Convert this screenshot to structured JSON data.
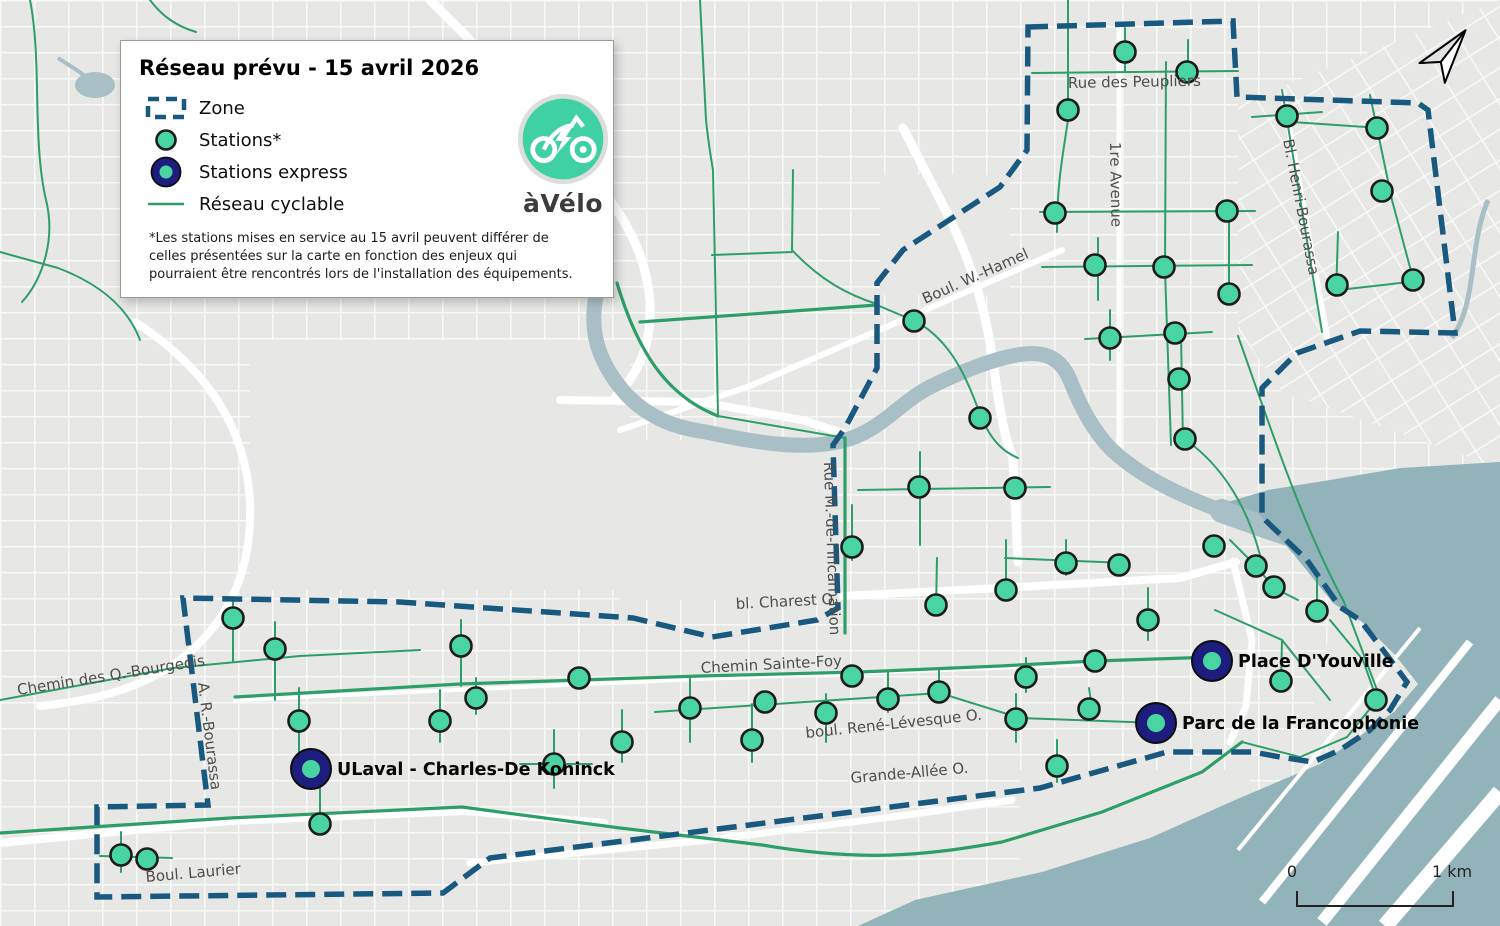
{
  "legend": {
    "title": "Réseau prévu - 15 avril 2026",
    "items": [
      {
        "id": "zone",
        "label": "Zone"
      },
      {
        "id": "station",
        "label": "Stations*"
      },
      {
        "id": "express",
        "label": "Stations express"
      },
      {
        "id": "network",
        "label": "Réseau cyclable"
      }
    ],
    "footnote": "*Les stations mises en service au 15 avril peuvent différer de celles présentées sur la carte en fonction des enjeux qui pourraient être rencontrés lors de l'installation des équipements."
  },
  "logo": {
    "brand": "àVélo"
  },
  "scale_bar": {
    "start_label": "0",
    "end_label": "1 km"
  },
  "colors": {
    "land": "#e7e8e5",
    "road": "#ffffff",
    "water_bay": "#93b3ba",
    "water_river": "#a9bfc6",
    "bike_network": "#2e9e68",
    "zone_boundary": "#19597f",
    "station_fill": "#49d5a2",
    "station_stroke": "#1c1c1c",
    "express_ring": "#1d1d7e",
    "logo_teal": "#3fd0a4",
    "street_label": "#4d4d4d",
    "station_label": "#050505"
  },
  "map": {
    "street_labels": [
      {
        "text": "Rue des Peupliers",
        "x": 1068,
        "y": 88,
        "rotate": -1
      },
      {
        "text": "1re Avenue",
        "x": 1110,
        "y": 142,
        "rotate": 89
      },
      {
        "text": "Bl. Henri-Bourassa",
        "x": 1283,
        "y": 140,
        "rotate": 79
      },
      {
        "text": "Boul. W.-Hamel",
        "x": 925,
        "y": 304,
        "rotate": -24
      },
      {
        "text": "Rue M.-de-l'Incarnation",
        "x": 824,
        "y": 462,
        "rotate": 88
      },
      {
        "text": "bl. Charest O.",
        "x": 736,
        "y": 609,
        "rotate": -3
      },
      {
        "text": "Chemin Sainte-Foy",
        "x": 701,
        "y": 673,
        "rotate": -3
      },
      {
        "text": "boul. René-Lévesque O.",
        "x": 806,
        "y": 738,
        "rotate": -6
      },
      {
        "text": "Grande-Allée O.",
        "x": 851,
        "y": 783,
        "rotate": -5
      },
      {
        "text": "Chemin des Q.-Bourgeois",
        "x": 18,
        "y": 695,
        "rotate": -9
      },
      {
        "text": "A. R.-Bourassa",
        "x": 198,
        "y": 683,
        "rotate": 83
      },
      {
        "text": "Boul. Laurier",
        "x": 146,
        "y": 882,
        "rotate": -5
      }
    ],
    "stations": [
      [
        1125,
        52
      ],
      [
        1187,
        72
      ],
      [
        1068,
        110
      ],
      [
        1287,
        116
      ],
      [
        1377,
        128
      ],
      [
        1382,
        191
      ],
      [
        1055,
        213
      ],
      [
        1227,
        211
      ],
      [
        1095,
        265
      ],
      [
        1164,
        267
      ],
      [
        1229,
        294
      ],
      [
        1337,
        285
      ],
      [
        1413,
        280
      ],
      [
        914,
        321
      ],
      [
        1110,
        338
      ],
      [
        1175,
        333
      ],
      [
        1179,
        379
      ],
      [
        980,
        418
      ],
      [
        1185,
        439
      ],
      [
        919,
        487
      ],
      [
        1015,
        488
      ],
      [
        852,
        547
      ],
      [
        1066,
        563
      ],
      [
        1119,
        565
      ],
      [
        1214,
        546
      ],
      [
        1256,
        566
      ],
      [
        1274,
        587
      ],
      [
        1006,
        590
      ],
      [
        936,
        605
      ],
      [
        1148,
        620
      ],
      [
        1317,
        611
      ],
      [
        233,
        618
      ],
      [
        275,
        649
      ],
      [
        299,
        721
      ],
      [
        320,
        824
      ],
      [
        121,
        855
      ],
      [
        147,
        859
      ],
      [
        461,
        646
      ],
      [
        476,
        698
      ],
      [
        440,
        721
      ],
      [
        579,
        678
      ],
      [
        554,
        764
      ],
      [
        622,
        742
      ],
      [
        690,
        708
      ],
      [
        765,
        702
      ],
      [
        826,
        713
      ],
      [
        852,
        676
      ],
      [
        888,
        699
      ],
      [
        752,
        740
      ],
      [
        939,
        692
      ],
      [
        1016,
        719
      ],
      [
        1026,
        677
      ],
      [
        1089,
        709
      ],
      [
        1095,
        661
      ],
      [
        1281,
        681
      ],
      [
        1376,
        700
      ],
      [
        1057,
        766
      ]
    ],
    "express_stations": [
      {
        "x": 311,
        "y": 769,
        "label": "ULaval - Charles-De Koninck"
      },
      {
        "x": 1156,
        "y": 723,
        "label": "Parc de la Francophonie"
      },
      {
        "x": 1212,
        "y": 661,
        "label": "Place D'Youville"
      }
    ]
  }
}
